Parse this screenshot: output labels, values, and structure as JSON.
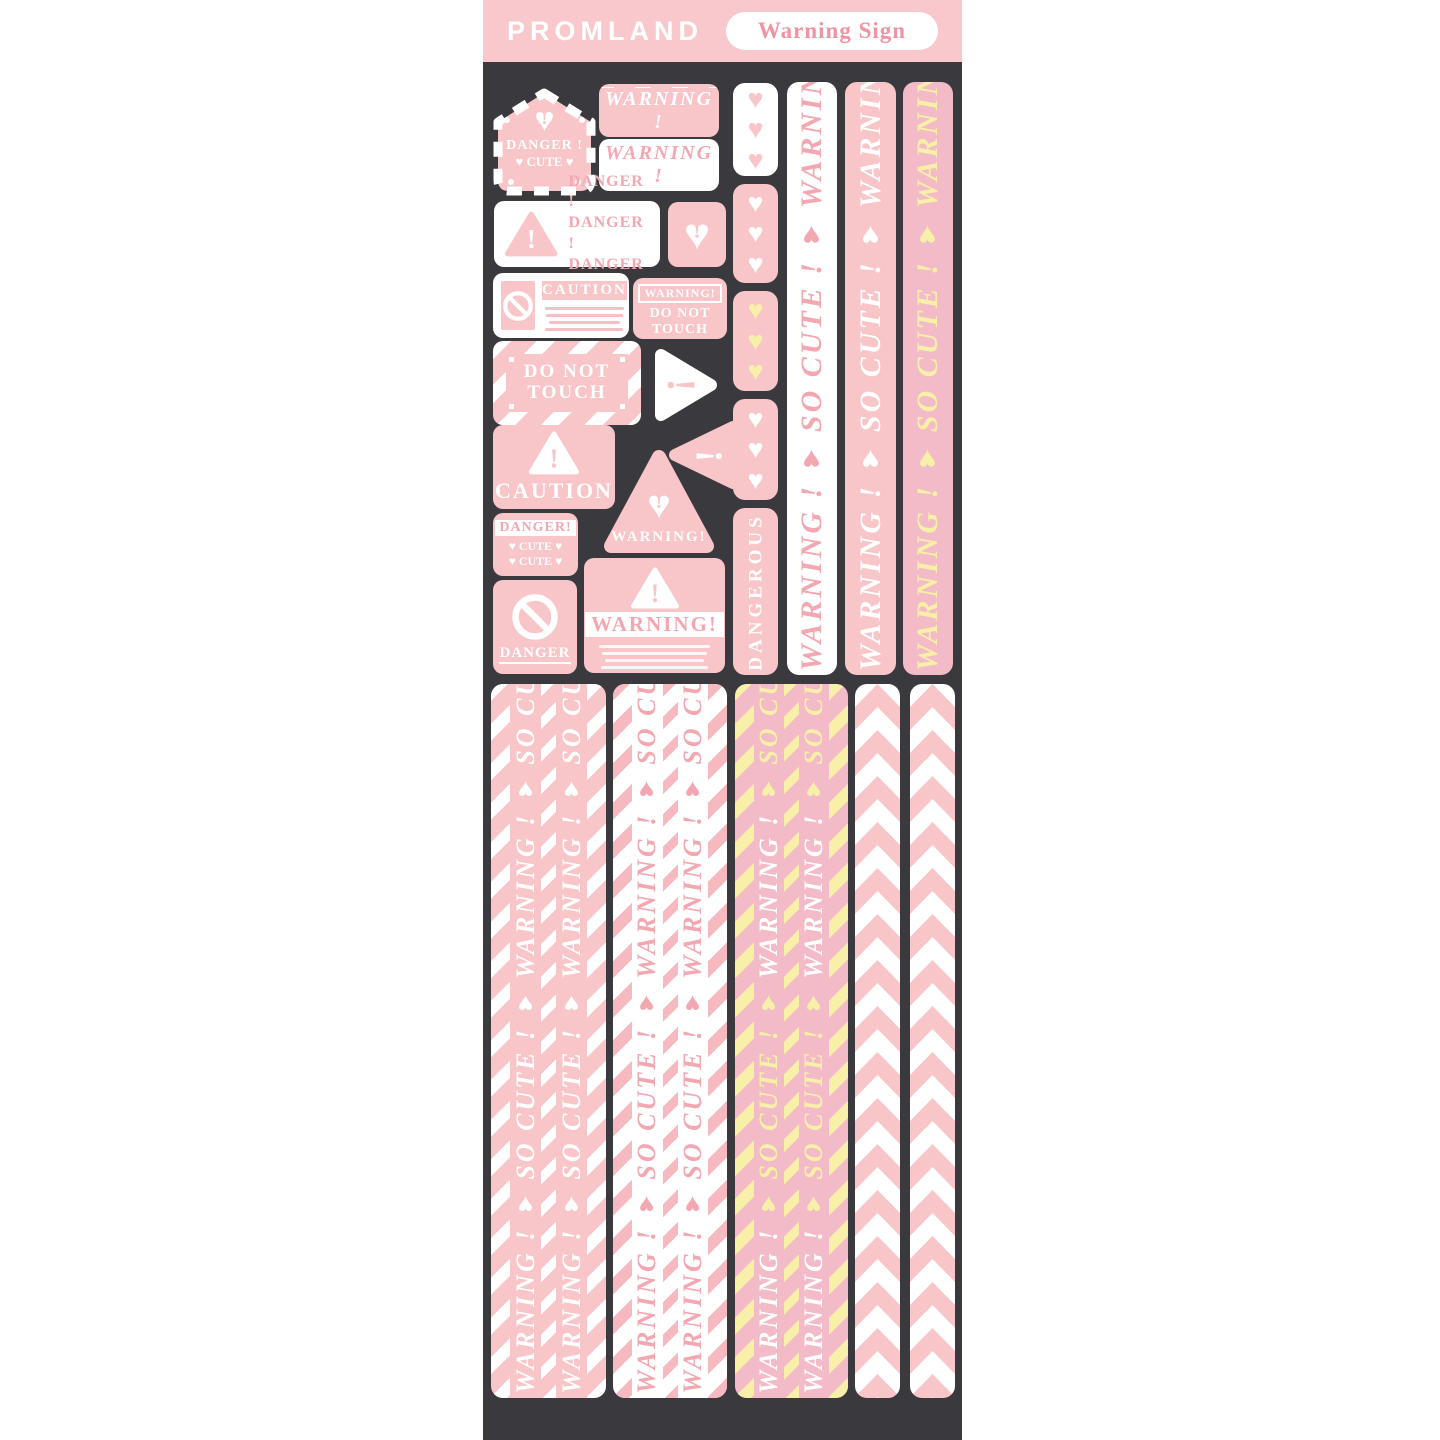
{
  "header": {
    "brand": "PROMLAND",
    "badge": "Warning Sign"
  },
  "colors": {
    "pink": "#f8c5c9",
    "rosy": "#f3bac7",
    "yellow": "#f8efa8",
    "dark": "#3a393d",
    "white": "#ffffff",
    "pink_text": "#f2a7b1"
  },
  "stickers": {
    "tag": {
      "line1": "DANGER !",
      "line2": "♥ CUTE ♥"
    },
    "warning_stripe_top": {
      "label": "WARNING !"
    },
    "warning_stripe_bottom": {
      "label": "WARNING !"
    },
    "danger_triple": {
      "line1": "DANGER !",
      "line2": "DANGER !",
      "line3": "DANGER !"
    },
    "caution_card": {
      "title": "CAUTION"
    },
    "warning_touch": {
      "badge": "WARNING!",
      "line1": "DO NOT",
      "line2": "TOUCH"
    },
    "do_not_touch": {
      "line1": "DO NOT",
      "line2": "TOUCH"
    },
    "caution_pink": {
      "title": "CAUTION"
    },
    "warning_triangle": {
      "label": "WARNING!"
    },
    "danger_cute": {
      "title": "DANGER!",
      "cute1": "♥ CUTE ♥",
      "cute2": "♥ CUTE ♥"
    },
    "danger_noentry": {
      "label": "DANGER"
    },
    "warning_big": {
      "label": "WARNING!"
    },
    "dangerous": {
      "label": "DANGEROUS"
    }
  },
  "hearts": {
    "segments": [
      {
        "count": 3,
        "bg": "#ffffff",
        "color": "#f8c5c9"
      },
      {
        "count": 3,
        "bg": "#f8c5c9",
        "color": "#ffffff"
      },
      {
        "count": 3,
        "bg": "#f8c5c9",
        "color": "#f8efa8"
      },
      {
        "count": 3,
        "bg": "#f8c5c9",
        "color": "#ffffff"
      }
    ]
  },
  "strips": {
    "vertical": [
      {
        "name": "warning-strip-white",
        "phrases": [
          {
            "t": "WARNING !"
          },
          {
            "t": "♥"
          },
          {
            "t": "SO CUTE !"
          },
          {
            "t": "♥"
          }
        ]
      },
      {
        "name": "warning-strip-pink",
        "phrases": [
          {
            "t": "WARNING !"
          },
          {
            "t": "♥"
          },
          {
            "t": "SO CUTE !"
          },
          {
            "t": "♥"
          }
        ]
      },
      {
        "name": "warning-strip-yellow",
        "phrases": [
          {
            "t": "WARNING !"
          },
          {
            "t": "♥"
          },
          {
            "t": "SO CUTE !"
          },
          {
            "t": "♥"
          }
        ]
      }
    ],
    "bottom": [
      {
        "name": "tape-pink",
        "phrases": [
          {
            "t": "WARNING !"
          },
          {
            "t": "♥"
          },
          {
            "t": "SO CUTE !"
          },
          {
            "t": "♥"
          }
        ]
      },
      {
        "name": "tape-white",
        "phrases": [
          {
            "t": "WARNING !"
          },
          {
            "t": "♥"
          },
          {
            "t": "SO CUTE !"
          },
          {
            "t": "♥"
          }
        ]
      },
      {
        "name": "tape-rosy",
        "phrases": [
          {
            "t": "WARNING !",
            "c": "#ffffff"
          },
          {
            "t": "♥",
            "c": "#f8efa8"
          },
          {
            "t": "SO CUTE !",
            "c": "#f8efa8"
          },
          {
            "t": "♥",
            "c": "#f8efa8"
          }
        ]
      }
    ]
  }
}
